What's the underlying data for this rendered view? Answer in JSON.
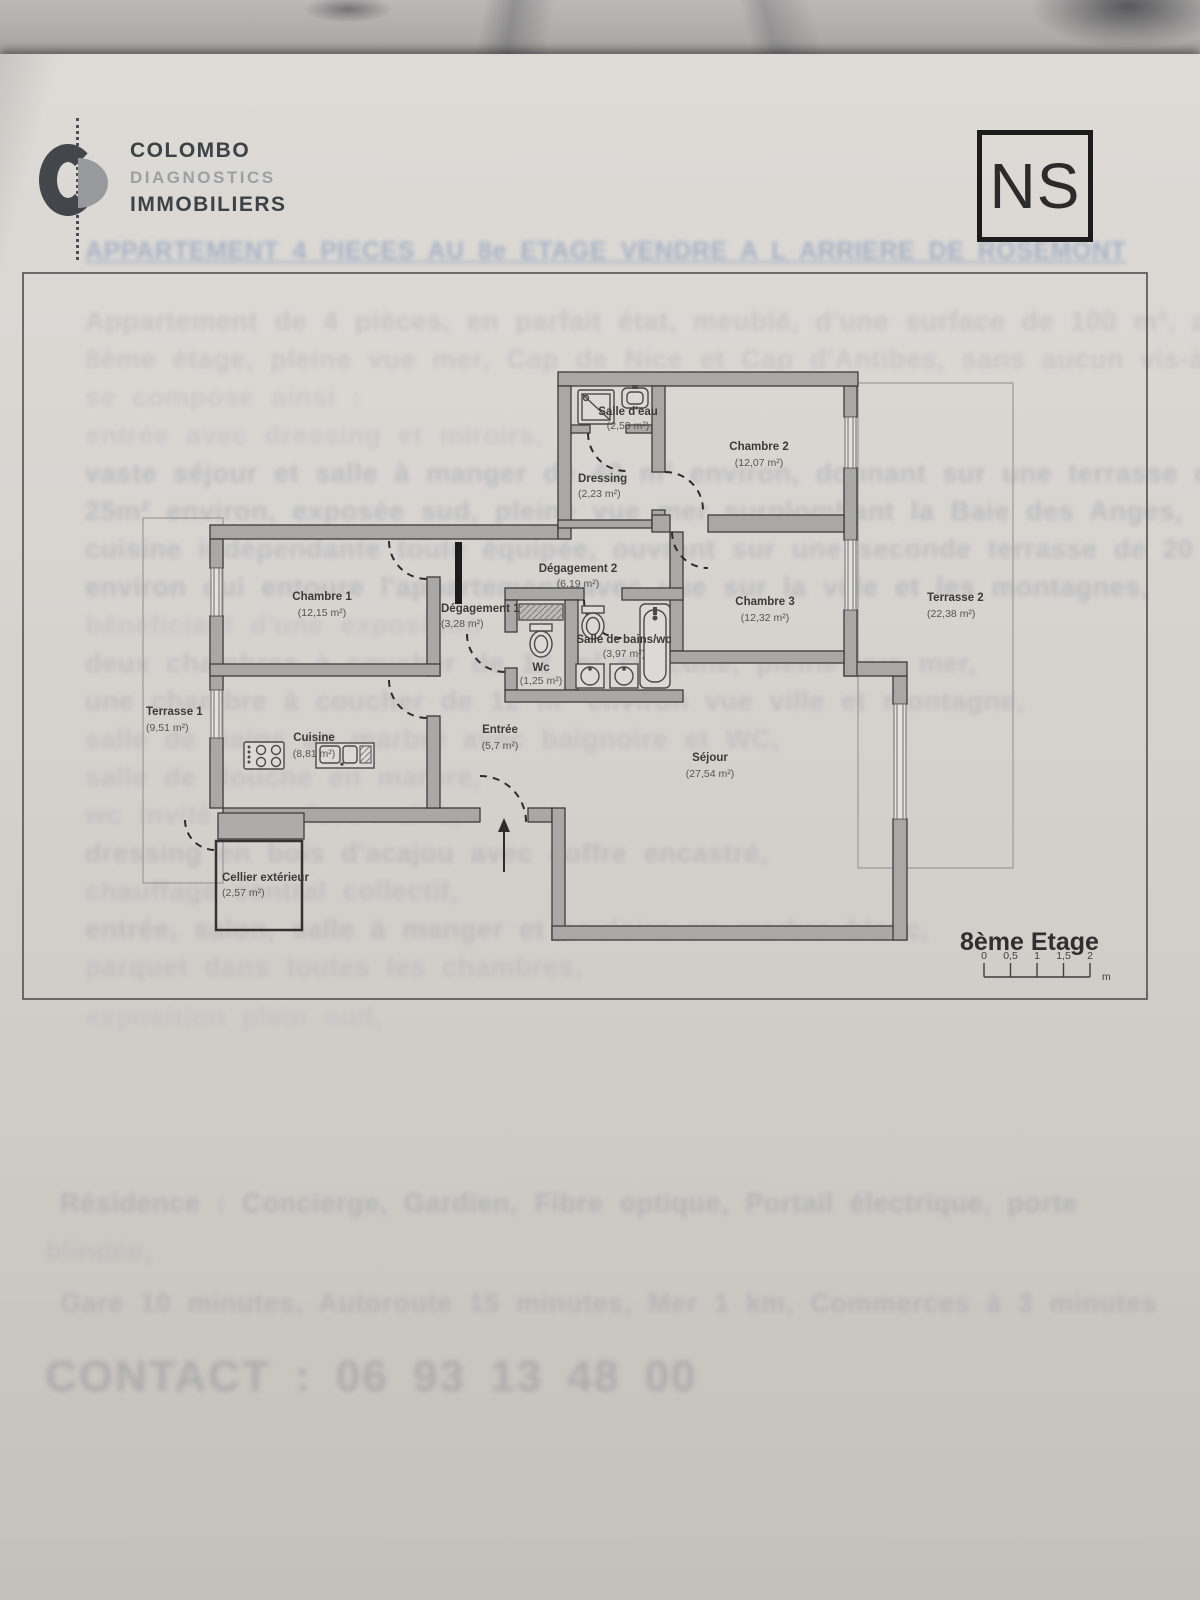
{
  "header": {
    "brand_line1": "COLOMBO",
    "brand_line2": "DIAGNOSTICS",
    "brand_line3": "IMMOBILIERS",
    "compass": "NS"
  },
  "plan": {
    "rooms": {
      "salle_deau": {
        "name": "Salle d'eau",
        "area": "(2,53 m²)"
      },
      "chambre2": {
        "name": "Chambre 2",
        "area": "(12,07 m²)"
      },
      "dressing": {
        "name": "Dressing",
        "area": "(2,23 m²)"
      },
      "degagement2": {
        "name": "Dégagement 2",
        "area": "(6,19 m²)"
      },
      "chambre1": {
        "name": "Chambre 1",
        "area": "(12,15 m²)"
      },
      "degagement1": {
        "name": "Dégagement 1",
        "area": "(3,28 m²)"
      },
      "wc": {
        "name": "Wc",
        "area": "(1,25 m²)"
      },
      "salle_bains": {
        "name": "Salle de bains/wc",
        "area": "(3,97 m²)"
      },
      "chambre3": {
        "name": "Chambre 3",
        "area": "(12,32 m²)"
      },
      "terrasse2": {
        "name": "Terrasse 2",
        "area": "(22,38 m²)"
      },
      "terrasse1": {
        "name": "Terrasse 1",
        "area": "(9,51 m²)"
      },
      "cuisine": {
        "name": "Cuisine",
        "area": "(8,81 m²)"
      },
      "entree": {
        "name": "Entrée",
        "area": "(5,7 m²)"
      },
      "sejour": {
        "name": "Séjour",
        "area": "(27,54 m²)"
      },
      "cellier": {
        "name": "Cellier extérieur",
        "area": "(2,57 m²)"
      }
    },
    "floor_label": "8ème Etage",
    "scale": {
      "ticks": [
        "0",
        "0,5",
        "1",
        "1,5",
        "2"
      ],
      "unit": "m"
    },
    "wall_color": "#a9a8a6",
    "outline_color": "#3c3c3c"
  },
  "ghost": {
    "title": "APPARTEMENT 4 PIECES AU 8e ETAGE  VENDRE A L ARRIERE DE ROSEMONT",
    "contact": "CONTACT : 06 93 13 48 00",
    "lines": [
      {
        "text": "Appartement de 4 pièces, en parfait état, meublé, d'une surface de 100 m², au",
        "y": 306,
        "o": 0.22
      },
      {
        "text": "8ème étage, pleine vue mer, Cap de Nice et Cap d'Antibes, sans aucun vis-à-vis,",
        "y": 344,
        "o": 0.2
      },
      {
        "text": "se compose ainsi :",
        "y": 382,
        "o": 0.16
      },
      {
        "text": "entrée avec dressing et miroirs,",
        "y": 420,
        "o": 0.16
      },
      {
        "text": "vaste séjour et salle à manger de 40 m² environ, donnant sur une terrasse de",
        "y": 458,
        "o": 0.3
      },
      {
        "text": "25m² environ, exposée sud, pleine vue mer surplombant la Baie des Anges,",
        "y": 496,
        "o": 0.3
      },
      {
        "text": "cuisine indépendante toute équipée, ouvrant sur une seconde terrasse de 20 m²",
        "y": 534,
        "o": 0.28
      },
      {
        "text": "environ qui entoure l'appartement avec vue sur la ville et les montagnes,",
        "y": 572,
        "o": 0.3
      },
      {
        "text": "bénéficiant d'une exposition",
        "y": 610,
        "o": 0.16
      },
      {
        "text": "deux chambres à coucher de 12 m² chacune, pleine vue mer,",
        "y": 648,
        "o": 0.24
      },
      {
        "text": "une chambre à coucher de 12 m² environ vue ville et montagne,",
        "y": 686,
        "o": 0.24
      },
      {
        "text": "salle de bains en marbre avec baignoire et WC,",
        "y": 724,
        "o": 0.2
      },
      {
        "text": "salle de douche en marbre,",
        "y": 762,
        "o": 0.2
      },
      {
        "text": "wc invité avec lave-mains,",
        "y": 800,
        "o": 0.18
      },
      {
        "text": "dressing en bois d'acajou avec coffre encastré,",
        "y": 838,
        "o": 0.26
      },
      {
        "text": "chauffage central collectif,",
        "y": 876,
        "o": 0.2
      },
      {
        "text": "entrée, salon, salle à manger et couloirs en marbre blanc,",
        "y": 914,
        "o": 0.24
      },
      {
        "text": "parquet dans toutes les chambres,",
        "y": 952,
        "o": 0.18
      },
      {
        "text": "exposition plein sud,",
        "y": 1002,
        "o": 0.12
      },
      {
        "text": "Résidence : Concierge, Gardien, Fibre optique, Portail électrique, porte",
        "y": 1188,
        "x": 60,
        "o": 0.3
      },
      {
        "text": "blindée,",
        "y": 1236,
        "x": 45,
        "o": 0.14
      },
      {
        "text": "Gare 10 minutes, Autoroute 15 minutes, Mer 1 km, Commerces à 3 minutes",
        "y": 1288,
        "x": 60,
        "o": 0.26
      }
    ]
  }
}
